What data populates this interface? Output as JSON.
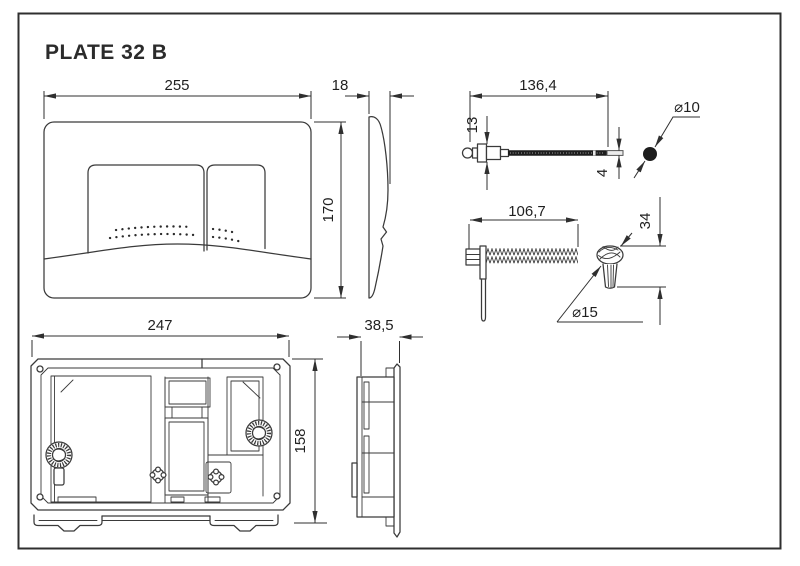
{
  "title": "PLATE 32 B",
  "colors": {
    "line": "#3a3a3a",
    "text": "#1f1f1f",
    "background": "#ffffff",
    "solid": "#1d1d1d"
  },
  "dims": {
    "front_width": "255",
    "front_height": "170",
    "plate_depth": "18",
    "cable_length": "136,4",
    "cable_head_height": "13",
    "cable_tip_diameter": "4",
    "ball_diameter": "⌀10",
    "screw_length": "106,7",
    "knob_height": "34",
    "knob_diameter": "⌀15",
    "frame_width": "247",
    "frame_height": "158",
    "frame_depth": "38,5"
  }
}
